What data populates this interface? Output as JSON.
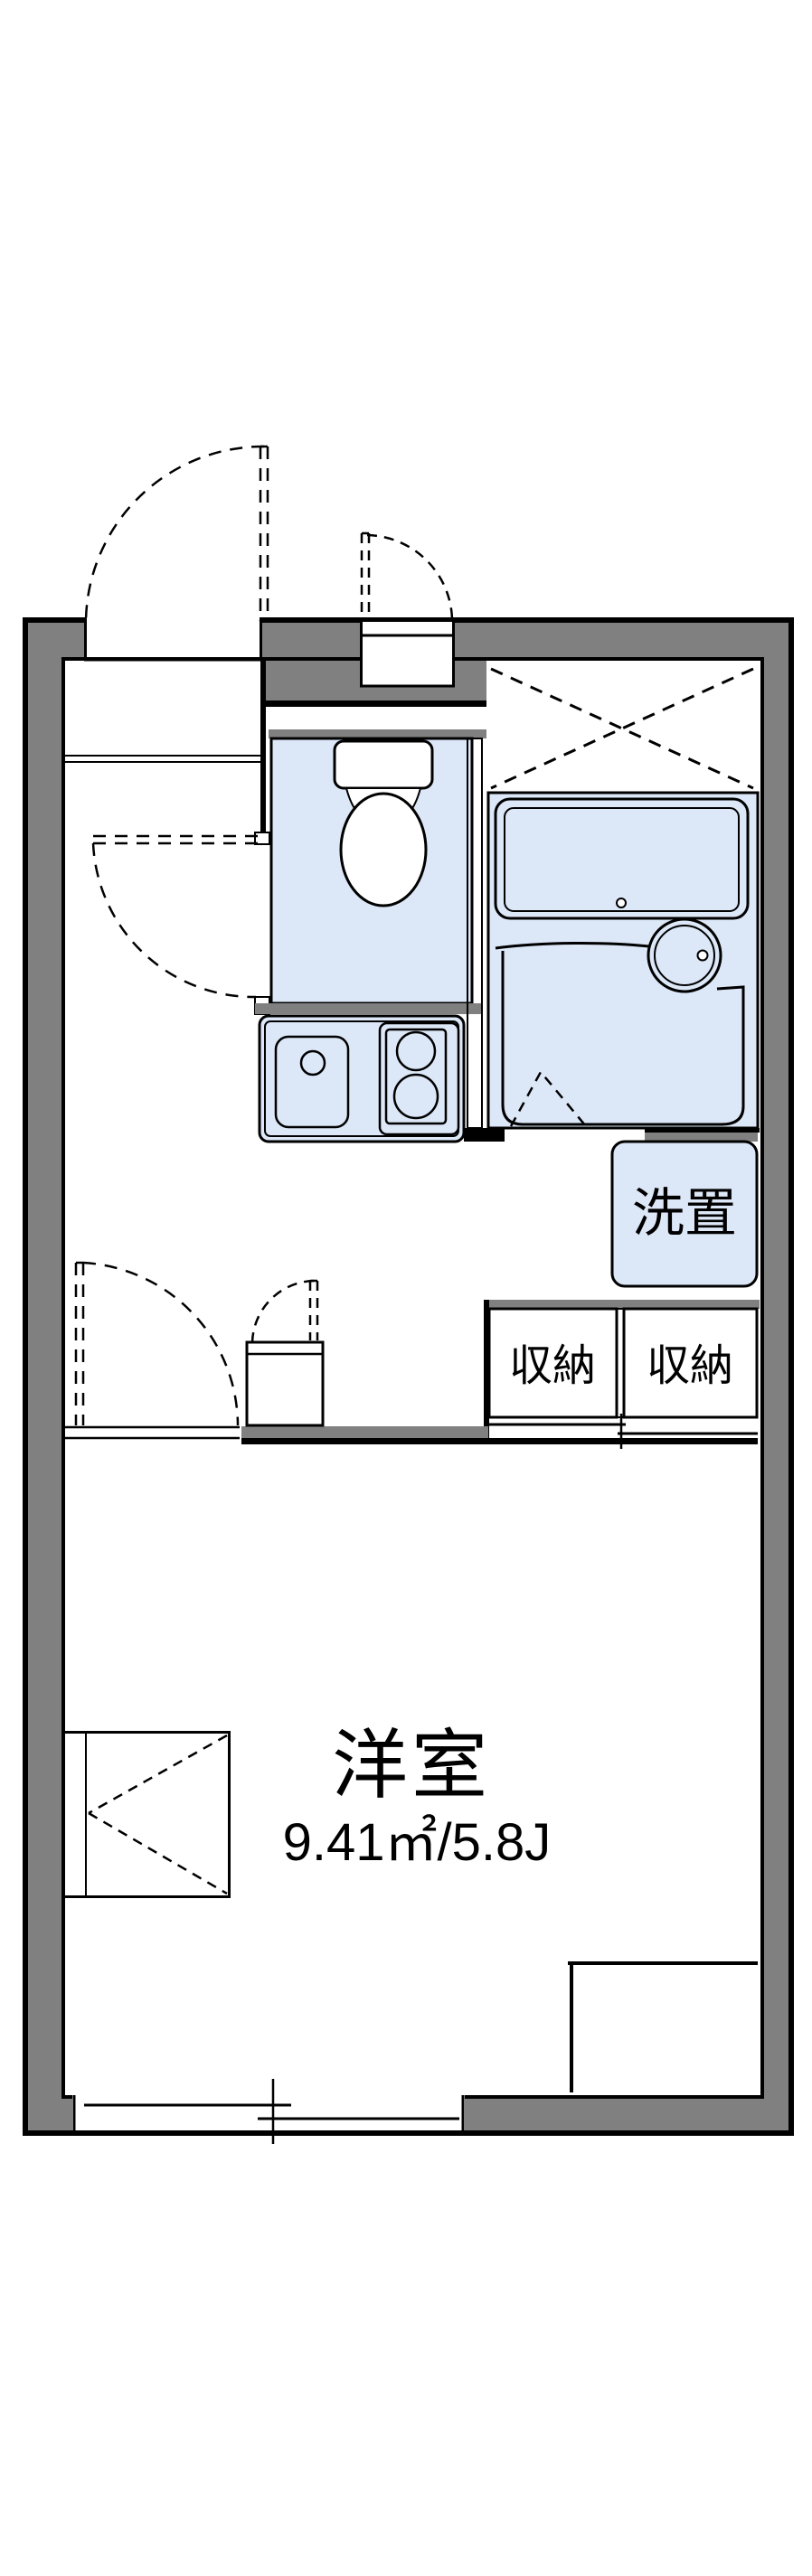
{
  "floor_plan": {
    "rooms": {
      "main_room": {
        "name": "洋室",
        "area_text": "9.41㎡/5.8J"
      },
      "washer_space_label": "洗置",
      "storage_left_label": "収納",
      "storage_right_label": "収納"
    },
    "colors": {
      "wall_gray": "#808080",
      "water_blue": "#dce7f7",
      "storage_cream": "#fbf0da",
      "line_black": "#000000",
      "background": "#ffffff"
    }
  }
}
